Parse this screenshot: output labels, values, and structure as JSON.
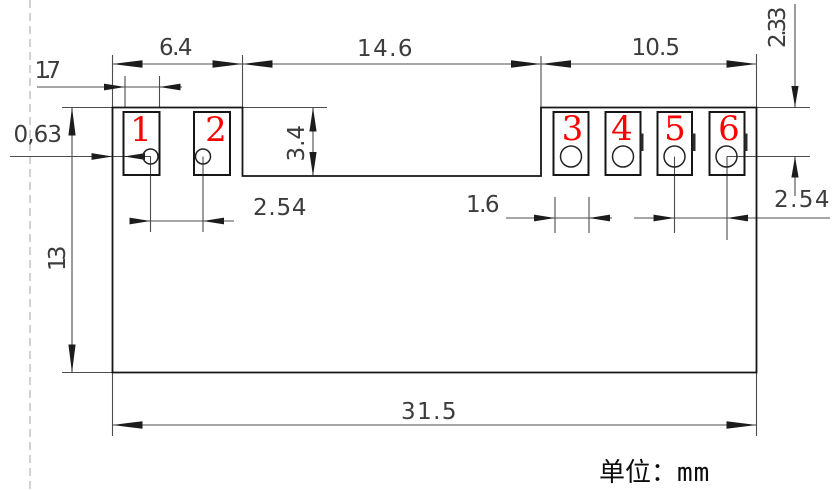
{
  "drawing": {
    "title": "module-footprint-dimension-drawing",
    "unit_note": {
      "label_cn": "单位：",
      "unit": "mm"
    },
    "pad_numbers": [
      "1",
      "2",
      "3",
      "4",
      "5",
      "6"
    ],
    "dims": {
      "left_group_width": "6.4",
      "middle_notch_width": "14.6",
      "right_group_width": "10.5",
      "left_pad_width": "1.7",
      "edge_to_pad_gap": "0,63",
      "notch_depth": "3.4",
      "left_hole_pitch": "2.54",
      "right_pad_width": "1.6",
      "right_hole_pitch": "2.54",
      "top_to_hole_center": "2.33",
      "body_height": "13",
      "body_width": "31.5"
    },
    "colors": {
      "pad_number": "#ff0000",
      "outline": "#161616",
      "dimension": "#4c4c4c",
      "construction": "#b4b4b4"
    }
  }
}
